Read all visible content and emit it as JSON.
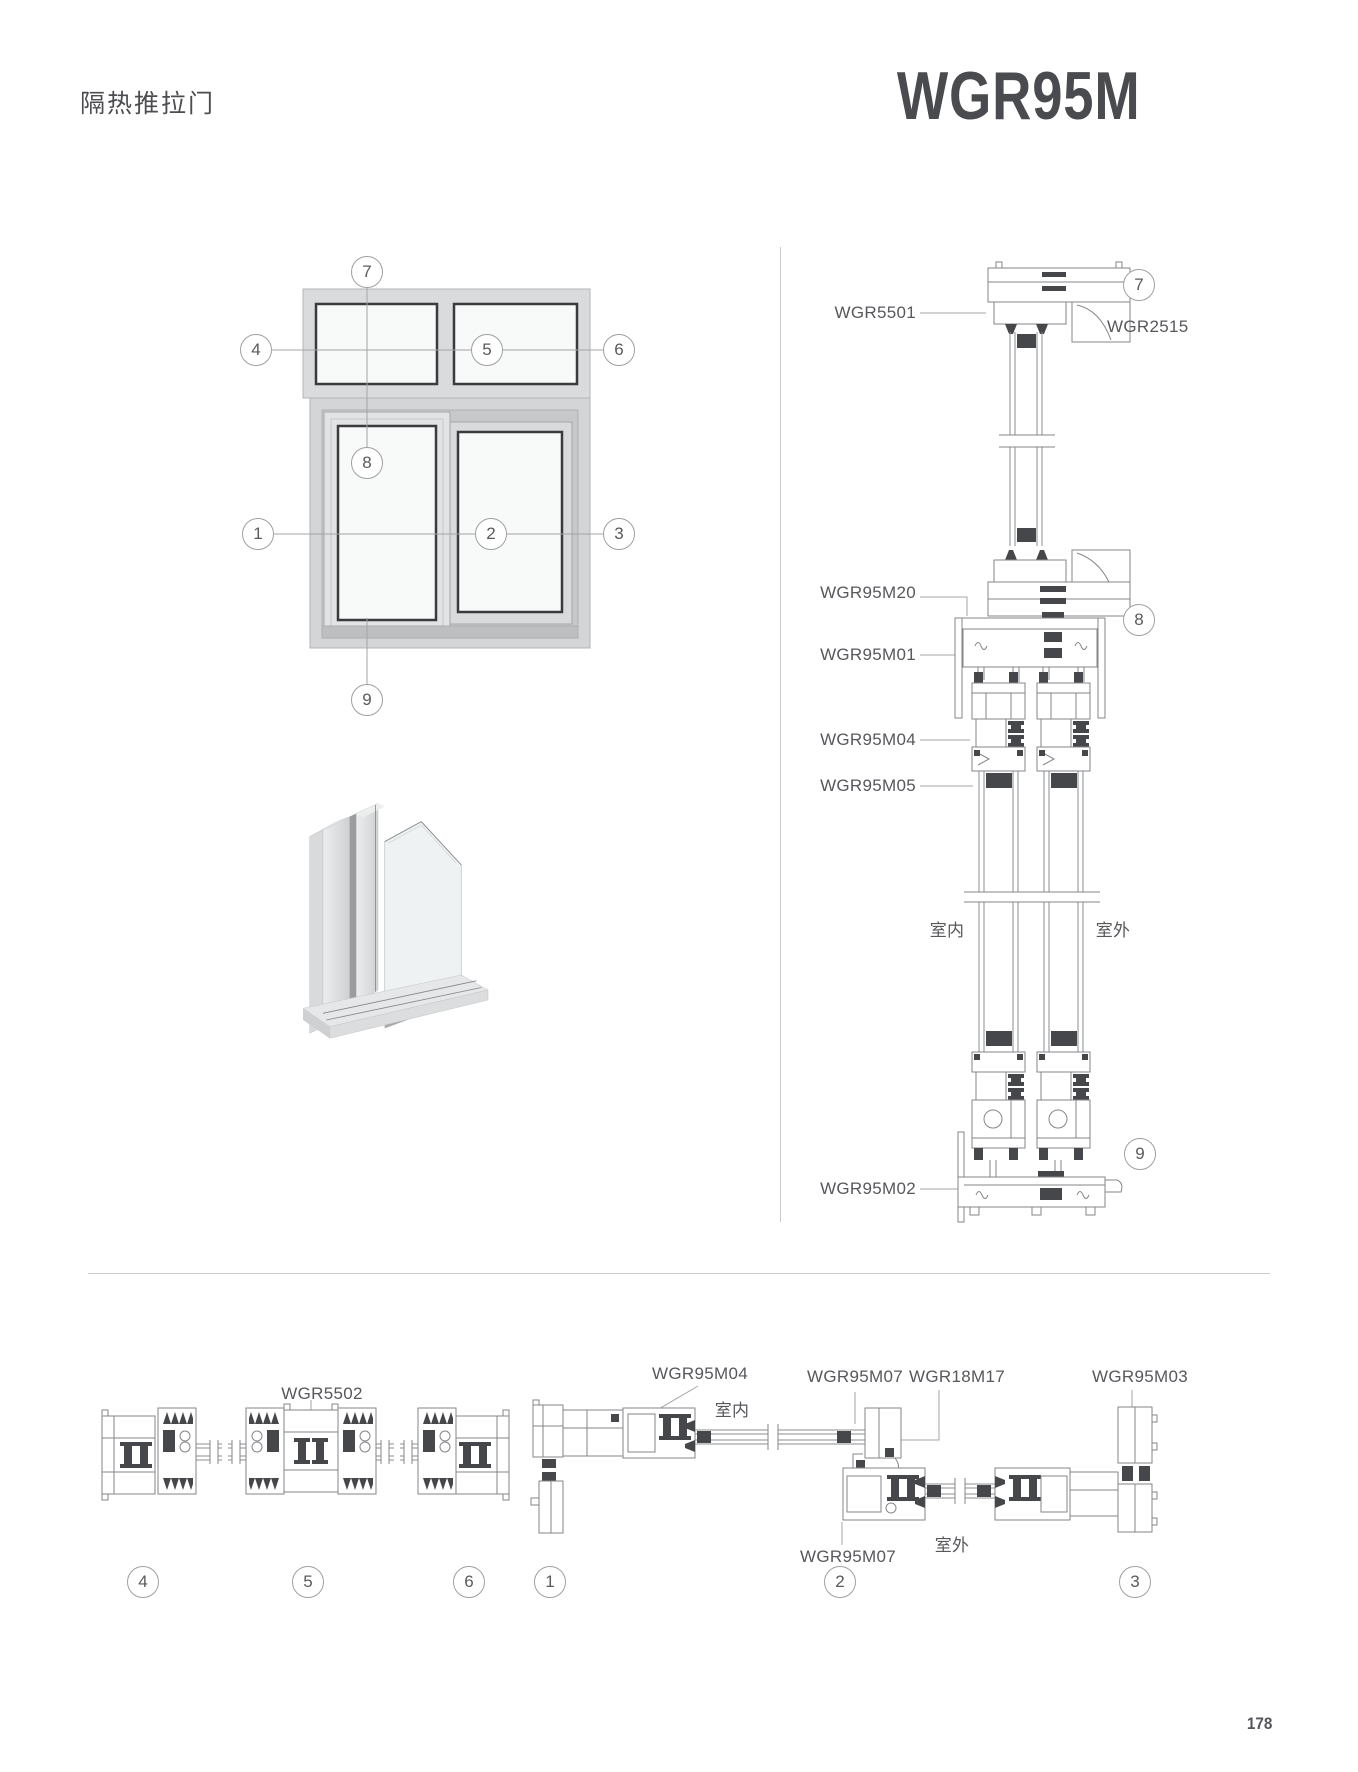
{
  "page": {
    "title": "隔热推拉门",
    "model": "WGR95M",
    "number": "178"
  },
  "elevation": {
    "callouts": {
      "n1": "1",
      "n2": "2",
      "n3": "3",
      "n4": "4",
      "n5": "5",
      "n6": "6",
      "n7": "7",
      "n8": "8",
      "n9": "9"
    }
  },
  "vertical_section": {
    "callouts": {
      "head": "7",
      "transom": "8",
      "sill": "9"
    },
    "labels": {
      "head_frame": "WGR5501",
      "glazing_bead": "WGR2515",
      "adapter": "WGR95M20",
      "transom": "WGR95M01",
      "sash_profile": "WGR95M04",
      "glazing_clamp": "WGR95M05",
      "sill": "WGR95M02"
    },
    "indoor": "室内",
    "outdoor": "室外"
  },
  "horizontal_left": {
    "labels": {
      "mullion": "WGR5502"
    },
    "callouts": [
      "4",
      "5",
      "6"
    ]
  },
  "horizontal_right": {
    "labels": {
      "interlock": "WGR95M04",
      "meeting_top": "WGR95M07",
      "corner_joint": "WGR18M17",
      "jamb": "WGR95M03",
      "meeting_bottom": "WGR95M07"
    },
    "indoor": "室内",
    "outdoor": "室外",
    "callouts": [
      "1",
      "2",
      "3"
    ]
  }
}
